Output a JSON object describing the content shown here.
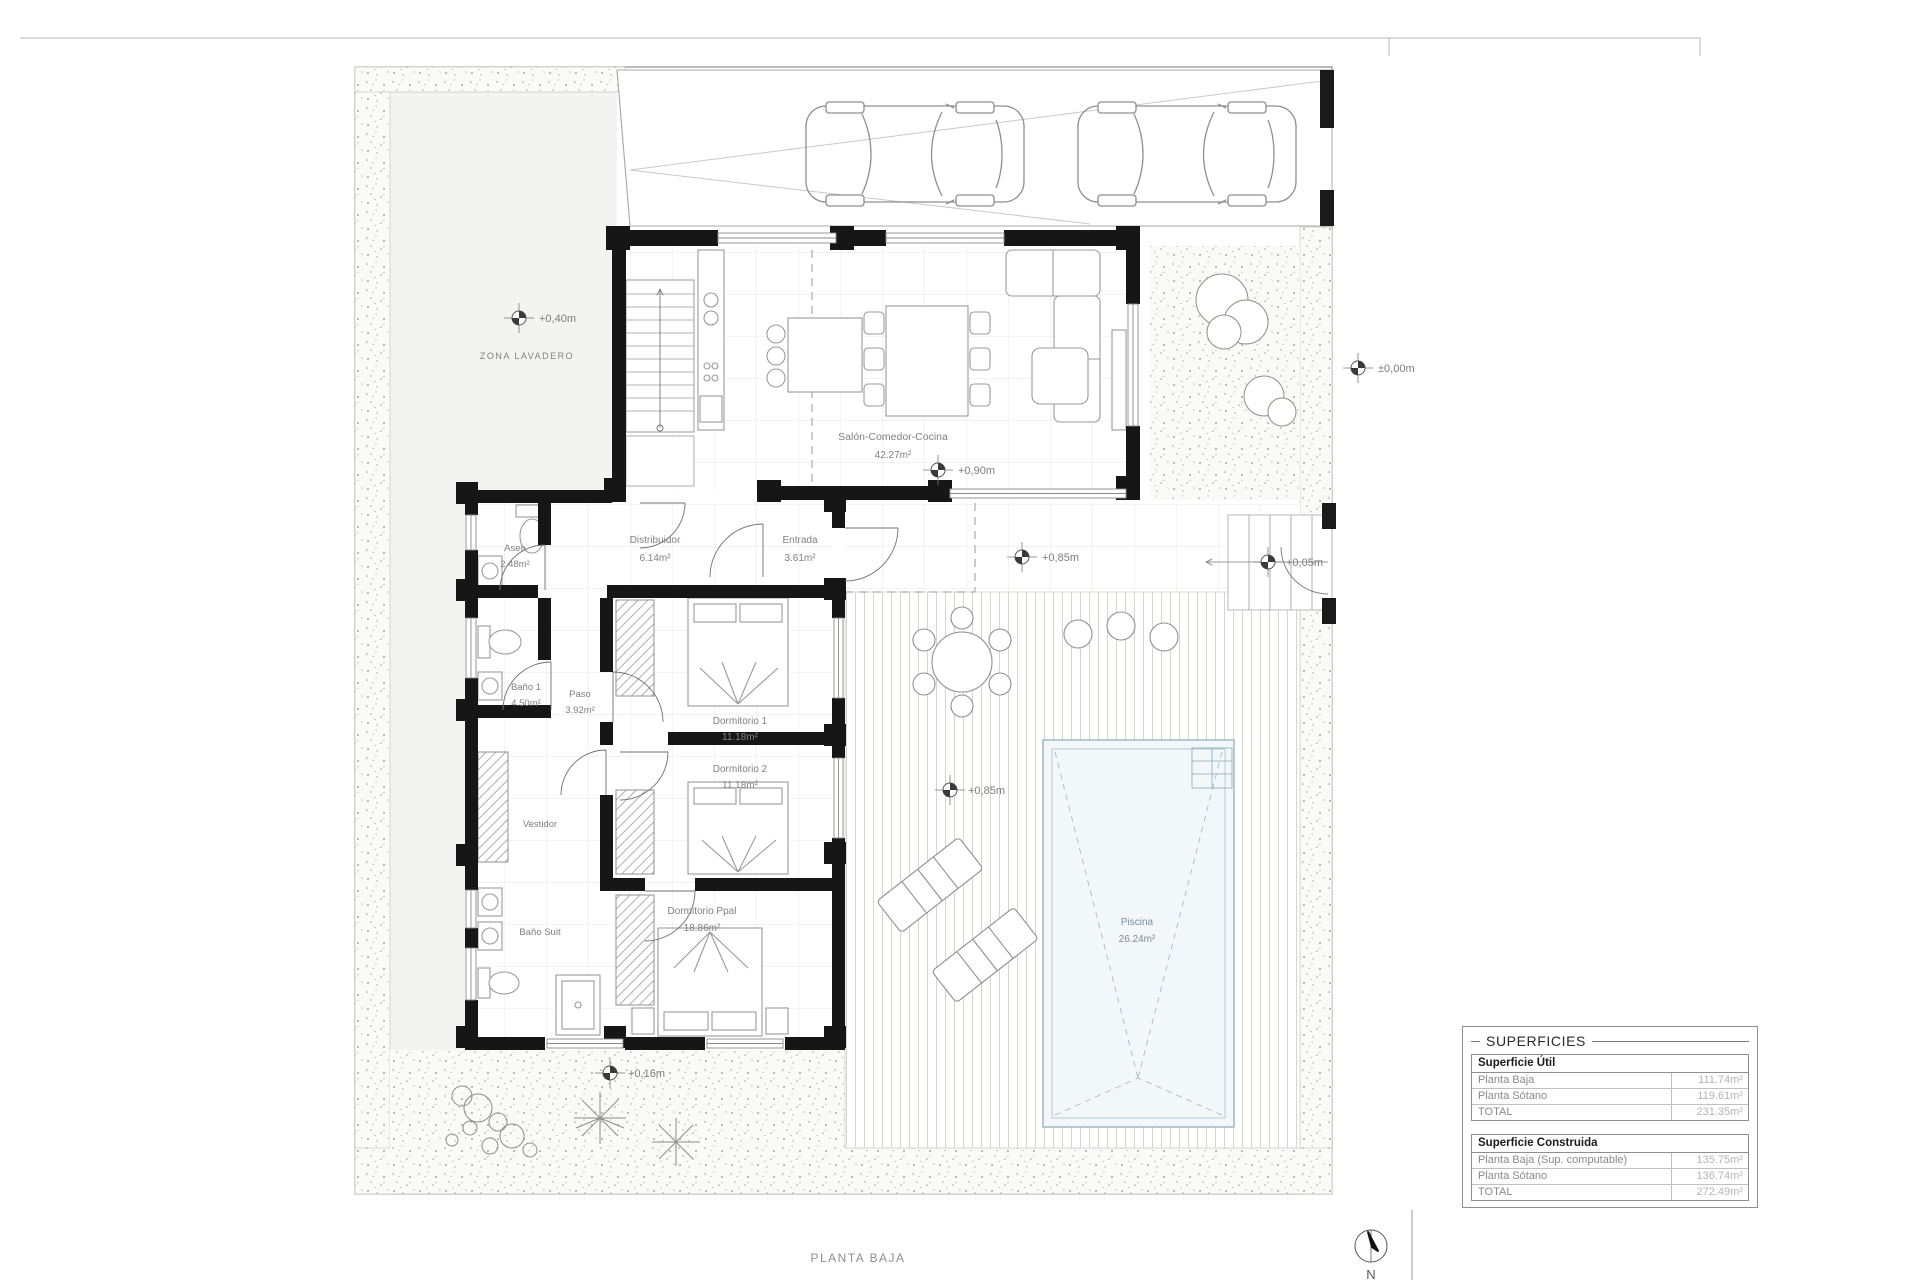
{
  "page": {
    "title": "PLANTA BAJA",
    "north": "N"
  },
  "areas": {
    "zona_lavadero": "ZONA LAVADERO"
  },
  "levels": {
    "lavadero": "+0,40m",
    "acera": "±0,00m",
    "salon": "+0,90m",
    "porche": "+0,85m",
    "escalera": "+0,05m",
    "terraza": "+0,85m",
    "jardin": "+0,16m"
  },
  "rooms": {
    "salon": {
      "name": "Salón-Comedor-Cocina",
      "area": "42.27m²"
    },
    "aseo": {
      "name": "Aseo",
      "area": "2.48m²"
    },
    "distribuidor": {
      "name": "Distribuidor",
      "area": "6.14m²"
    },
    "entrada": {
      "name": "Entrada",
      "area": "3.61m²"
    },
    "bano1": {
      "name": "Baño 1",
      "area": "4.50m²"
    },
    "paso": {
      "name": "Paso",
      "area": "3.92m²"
    },
    "dorm1": {
      "name": "Dormitorio 1",
      "area": "11.18m²"
    },
    "dorm2": {
      "name": "Dormitorio 2",
      "area": "11.18m²"
    },
    "vestidor": {
      "name": "Vestidor"
    },
    "banosuit": {
      "name": "Baño Suit"
    },
    "dormppal": {
      "name": "Dormitorio Ppal",
      "area": "18.86m²"
    },
    "piscina": {
      "name": "Piscina",
      "area": "26.24m²"
    }
  },
  "superficies": {
    "title": "SUPERFICIES",
    "sections": [
      {
        "header": "Superficie Útil",
        "rows": [
          {
            "label": "Planta Baja",
            "value": "111.74m²"
          },
          {
            "label": "Planta Sótano",
            "value": "119.61m²"
          },
          {
            "label": "TOTAL",
            "value": "231.35m²"
          }
        ]
      },
      {
        "header": "Superficie Construida",
        "rows": [
          {
            "label": "Planta Baja (Sup. computable)",
            "value": "135.75m²"
          },
          {
            "label": "Planta Sótano",
            "value": "136.74m²"
          },
          {
            "label": "TOTAL",
            "value": "272.49m²"
          }
        ]
      }
    ]
  }
}
